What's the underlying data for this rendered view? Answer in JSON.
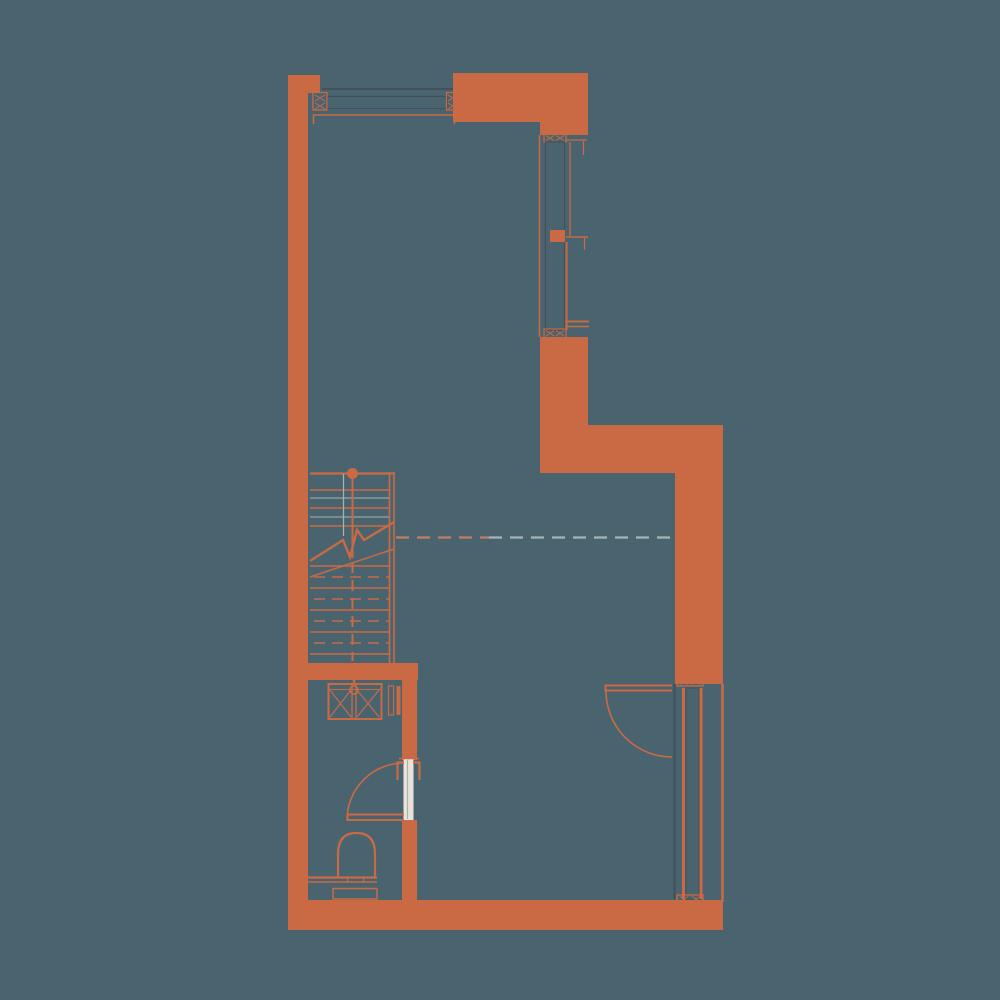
{
  "meta": {
    "title": "Apartment floor plan drawing",
    "diagram_kind": "architectural-floor-plan",
    "visible_text": []
  },
  "colors": {
    "background": "#4a646f",
    "wall": "#c96a45",
    "glass": "#ebe3da",
    "outline_dark": "#41505a",
    "rail_gray": "#a5b3b5",
    "dash_gray": "#a7b5b6",
    "dash_orange": "#c57d62"
  },
  "plan": {
    "walls": [
      "left-exterior-wall",
      "top-left-pier",
      "top-right-wall",
      "east-upper-wall",
      "east-mid-wall",
      "step-wall-band",
      "east-lower-wall",
      "bottom-exterior-wall",
      "wc-top-wall",
      "wc-right-wall"
    ],
    "windows": [
      {
        "id": "top-window",
        "orientation": "horizontal"
      },
      {
        "id": "east-window",
        "orientation": "vertical",
        "sashes": 2
      },
      {
        "id": "entry-sidelight-window",
        "orientation": "vertical"
      }
    ],
    "doors": [
      {
        "id": "entry-door",
        "swing": "quarter-arc-inward"
      },
      {
        "id": "wc-door",
        "swing": "quarter-arc-inward"
      }
    ],
    "stairs": {
      "upper_solid_treads": 4,
      "lower_solid_treads": 5,
      "dashed_treads": 4,
      "has_break_line": true,
      "has_newel_dot": true
    },
    "fixtures": [
      "wc-cabinet-with-cross",
      "toilet",
      "wc-niche"
    ],
    "reference_lines": [
      "horizontal-dashed-level-line"
    ]
  }
}
